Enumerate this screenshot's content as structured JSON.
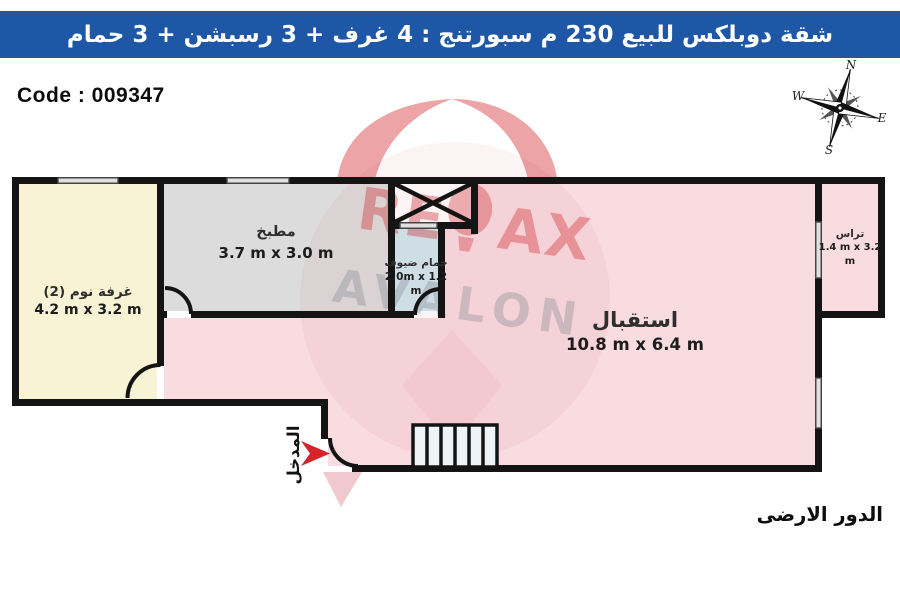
{
  "header": {
    "title": "شقة دوبلكس للبيع 230 م سبورتنج : 4 غرف + 3 رسبشن + 3 حمام"
  },
  "code": {
    "label": "Code : 009347"
  },
  "compass": {
    "n": "N",
    "e": "E",
    "s": "S",
    "w": "W"
  },
  "rooms": {
    "bedroom2": {
      "name": "غرفة نوم (2)",
      "dims": "4.2 m x 3.2 m"
    },
    "kitchen": {
      "name": "مطبخ",
      "dims": "3.7 m x 3.0 m"
    },
    "guest_bath": {
      "name": "حمام ضيوف",
      "dims": "2.0m x 1.2 m"
    },
    "reception": {
      "name": "استقبال",
      "dims": "10.8 m x 6.4 m"
    },
    "terrace": {
      "name": "تراس",
      "dims": "1.4 m x 3.2 m"
    }
  },
  "entrance": {
    "label": "المدخل"
  },
  "floor": {
    "label": "الدور الارضى"
  },
  "watermark": {
    "re": "RE",
    "ax": "AX",
    "sub": "AVALON"
  },
  "colors": {
    "header_bg": "#1d57a5",
    "wall": "#141414",
    "bedroom_fill": "#f9f3d6",
    "kitchen_fill": "#dcdcdc",
    "bathroom_fill": "#cfe9ef",
    "pink_fill": "#f8dce0",
    "window_fill": "#e0e0e0",
    "arrow_red": "#d8232a",
    "watermark_red": "#cc2229",
    "watermark_gray": "#8d929c"
  }
}
